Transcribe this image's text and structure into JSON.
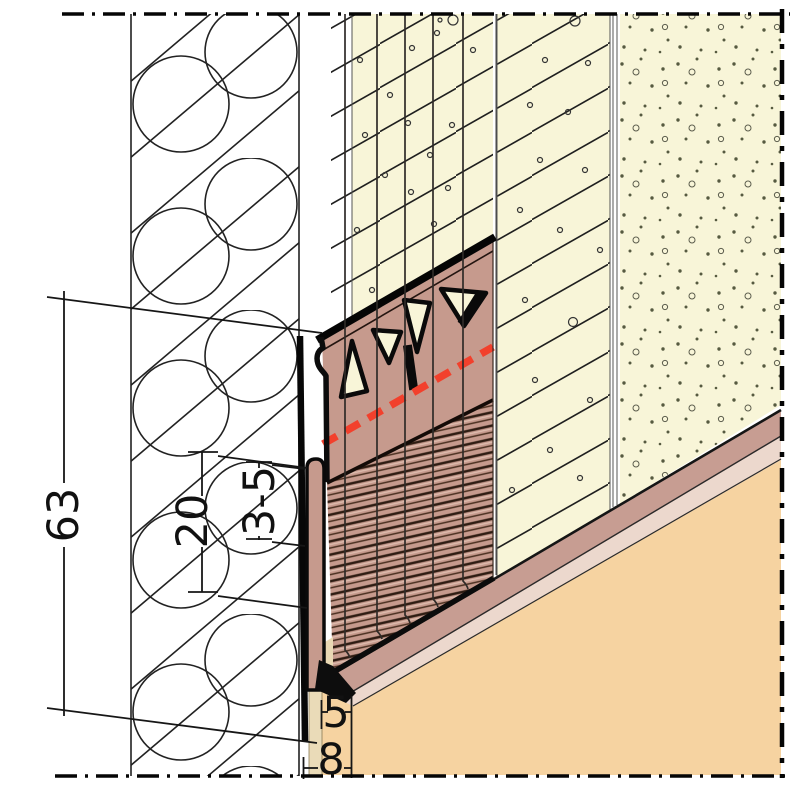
{
  "dims": {
    "height": {
      "label": "63"
    },
    "lip": {
      "label": "20"
    },
    "gap": {
      "label": "3-5"
    },
    "drip": {
      "label": "5"
    },
    "offset": {
      "label": "8"
    }
  },
  "colors": {
    "render_cream": "#f8f5d8",
    "profile_salmon": "#c69a8d",
    "stripe_mauve": "#c79d92",
    "stripe_pink": "#ecd8cd",
    "substrate_orange": "#f6d3a1",
    "wall_strip_tan": "#eadbb8",
    "tear_off_red": "#f2402c",
    "line_black": "#111111"
  }
}
